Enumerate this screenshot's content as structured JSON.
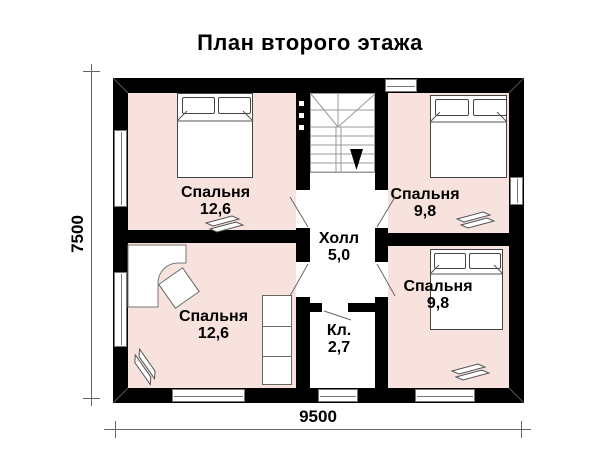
{
  "title": "План второго этажа",
  "rooms": [
    {
      "name": "Спальня",
      "area": "12,6",
      "position": "top-left"
    },
    {
      "name": "Спальня",
      "area": "9,8",
      "position": "top-right"
    },
    {
      "name": "Спальня",
      "area": "12,6",
      "position": "bottom-left"
    },
    {
      "name": "Спальня",
      "area": "9,8",
      "position": "bottom-right"
    },
    {
      "name": "Холл",
      "area": "5,0",
      "position": "center-hall"
    },
    {
      "name": "Кл.",
      "area": "2,7",
      "position": "center-closet"
    }
  ],
  "dimensions": {
    "width_label": "9500",
    "height_label": "7500"
  },
  "icons": {
    "stairs_direction": "down-arrow",
    "footwear": "slippers"
  },
  "colors": {
    "wall": "#000000",
    "room_fill": "#f8e2de",
    "line": "#777777",
    "background": "#ffffff"
  }
}
